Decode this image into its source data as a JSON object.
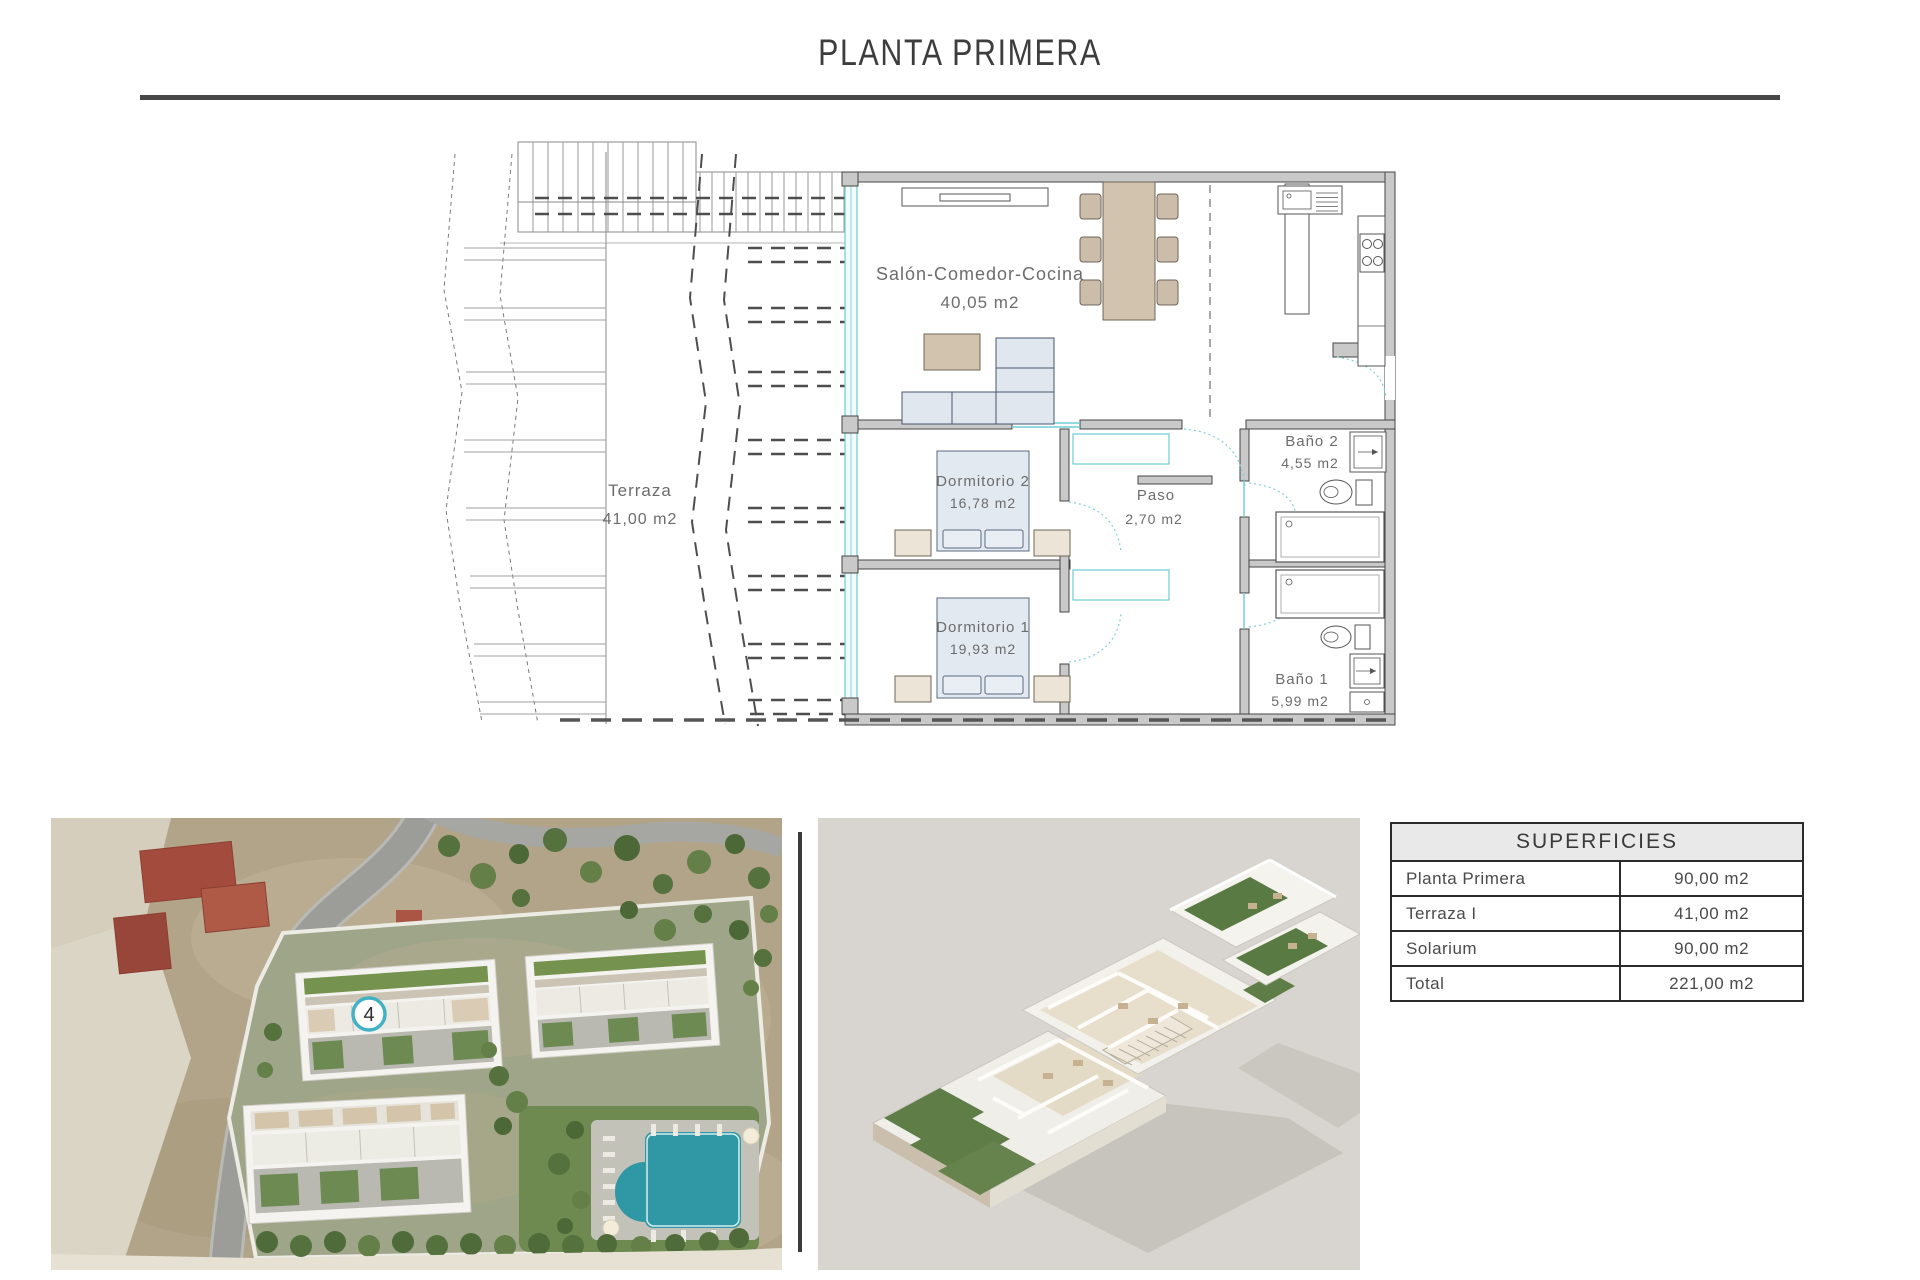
{
  "page": {
    "title": "PLANTA PRIMERA"
  },
  "floor_plan": {
    "rooms": [
      {
        "label": "Salón-Comedor-Cocina",
        "area": "40,05 m2"
      },
      {
        "label": "Terraza",
        "area": "41,00 m2"
      },
      {
        "label": "Dormitorio 2",
        "area": "16,78 m2"
      },
      {
        "label": "Dormitorio 1",
        "area": "19,93 m2"
      },
      {
        "label": "Baño 2",
        "area": "4,55 m2"
      },
      {
        "label": "Paso",
        "area": "2,70 m2"
      },
      {
        "label": "Baño 1",
        "area": "5,99 m2"
      }
    ]
  },
  "site_plan": {
    "unit_marker": "4"
  },
  "areas_table": {
    "header": "SUPERFICIES",
    "rows": [
      {
        "label": "Planta Primera",
        "value": "90,00 m2"
      },
      {
        "label": "Terraza I",
        "value": "41,00 m2"
      },
      {
        "label": "Solarium",
        "value": "90,00 m2"
      },
      {
        "label": "Total",
        "value": "221,00 m2"
      }
    ]
  },
  "colors": {
    "wall_gray": "#c9c9c9",
    "glass_teal": "#6fcdd2",
    "furniture_tan": "#d2c3ae",
    "furniture_blue": "#e0e7ef",
    "pool_teal": "#2f98a4",
    "text_gray": "#6c6c6c",
    "line_dark": "#474747"
  }
}
